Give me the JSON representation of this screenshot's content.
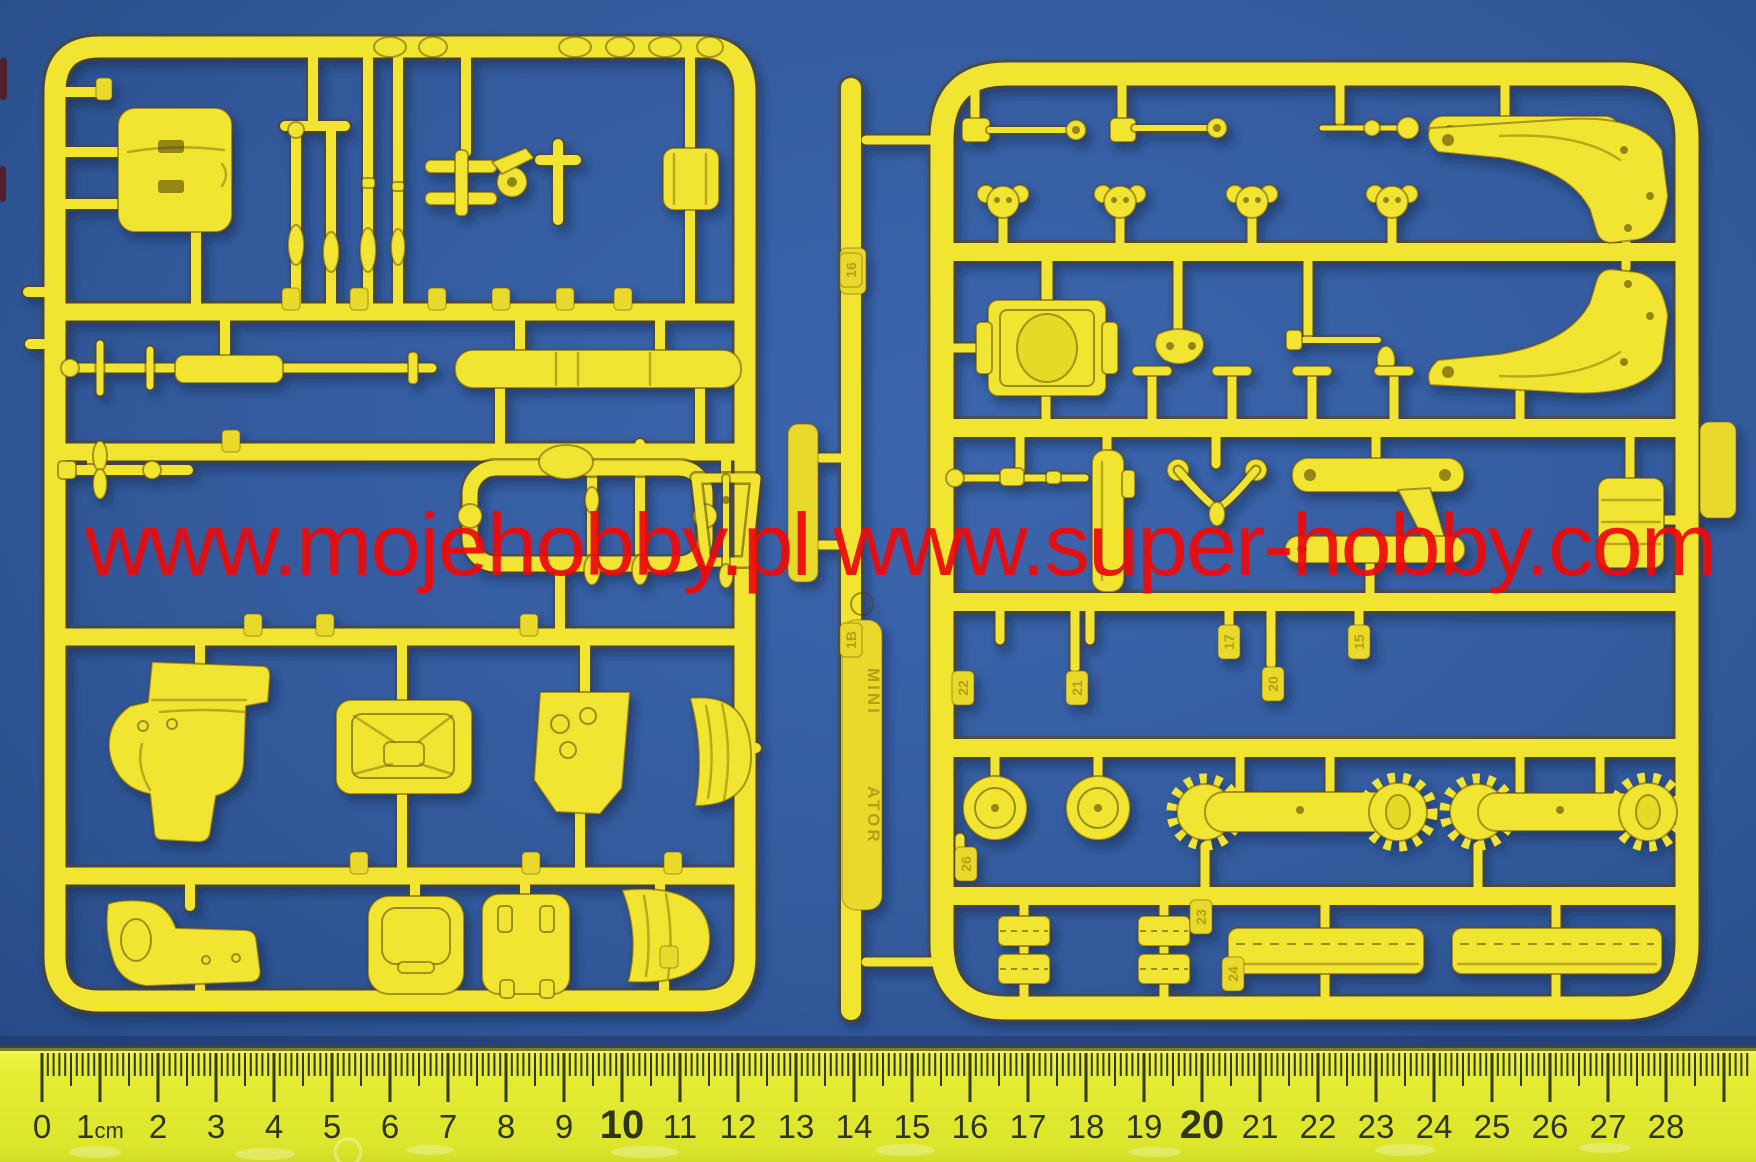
{
  "colors": {
    "background": "#33599b",
    "background_light": "#3c66ae",
    "background_dark": "#234680",
    "sprue_yellow": "#f1e531",
    "tab_fill": "#e9d92c",
    "watermark_red": "#ee0a0a",
    "ruler_yellow": "#e4ec33",
    "ruler_text": "#303418",
    "ruler_tick": "#343818"
  },
  "watermark": {
    "text": "www.mojehobby.pl www.super-hobby.com"
  },
  "ruler": {
    "unit": "cm",
    "numbers": [
      "0",
      "1cm",
      "2",
      "3",
      "4",
      "5",
      "6",
      "7",
      "8",
      "9",
      "10",
      "11",
      "12",
      "13",
      "14",
      "15",
      "16",
      "17",
      "18",
      "19",
      "20",
      "21",
      "22",
      "23",
      "24",
      "25",
      "26",
      "27",
      "28"
    ],
    "bold_numbers": [
      "10",
      "20"
    ]
  },
  "sprues": {
    "left": {
      "name": "left parts sprue"
    },
    "right": {
      "name": "right parts sprue",
      "part_number_tabs": [
        "16",
        "1B",
        "22",
        "21",
        "20",
        "17",
        "15",
        "26",
        "23",
        "24"
      ],
      "runner_labels": [
        "MINI",
        "ATOR"
      ]
    }
  }
}
